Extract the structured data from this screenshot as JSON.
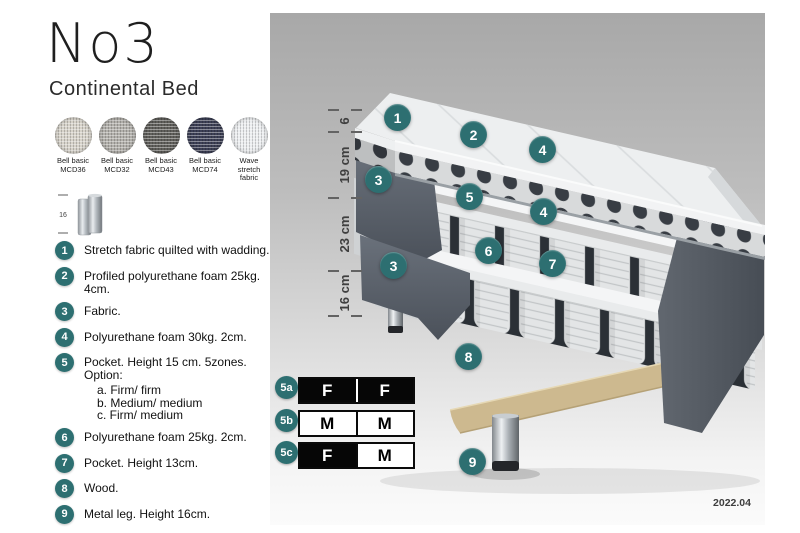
{
  "header": {
    "title": "No3",
    "subtitle": "Continental Bed"
  },
  "swatches": [
    {
      "line1": "Bell basic",
      "line2": "MCD36",
      "color": "#d7d3ca"
    },
    {
      "line1": "Bell basic",
      "line2": "MCD32",
      "color": "#b2b0ab"
    },
    {
      "line1": "Bell basic",
      "line2": "MCD43",
      "color": "#605f5b"
    },
    {
      "line1": "Bell basic",
      "line2": "MCD74",
      "color": "#3d4056"
    },
    {
      "line1": "Wave",
      "line2": "stretch fabric",
      "color": "#eceef0"
    }
  ],
  "leg_thumb": {
    "height_label": "16"
  },
  "materials": [
    {
      "num": "1",
      "text": "Stretch fabric quilted with wadding."
    },
    {
      "num": "2",
      "text": "Profiled polyurethane foam 25kg. 4cm."
    },
    {
      "num": "3",
      "text": "Fabric."
    },
    {
      "num": "4",
      "text": "Polyurethane foam 30kg. 2cm."
    },
    {
      "num": "5",
      "text": "Pocket. Height 15 cm. 5zones. Option:",
      "options": [
        "a. Firm/ firm",
        "b. Medium/ medium",
        "c. Firm/ medium"
      ]
    },
    {
      "num": "6",
      "text": "Polyurethane foam 25kg. 2cm."
    },
    {
      "num": "7",
      "text": "Pocket. Height 13cm."
    },
    {
      "num": "8",
      "text": "Wood."
    },
    {
      "num": "9",
      "text": "Metal leg. Height 16cm."
    }
  ],
  "measurements": [
    {
      "label": "6"
    },
    {
      "label": "19 cm"
    },
    {
      "label": "23 cm"
    },
    {
      "label": "16 cm"
    }
  ],
  "callouts": [
    {
      "num": "1"
    },
    {
      "num": "2"
    },
    {
      "num": "4"
    },
    {
      "num": "3"
    },
    {
      "num": "5"
    },
    {
      "num": "4"
    },
    {
      "num": "6"
    },
    {
      "num": "7"
    },
    {
      "num": "3"
    },
    {
      "num": "8"
    },
    {
      "num": "9"
    }
  ],
  "firmness": {
    "rows": [
      {
        "label": "5a",
        "cells": [
          {
            "value": "F"
          },
          {
            "value": "F"
          }
        ]
      },
      {
        "label": "5b",
        "cells": [
          {
            "value": "M"
          },
          {
            "value": "M"
          }
        ]
      },
      {
        "label": "5c",
        "cells": [
          {
            "value": "F"
          },
          {
            "value": "M"
          }
        ]
      }
    ]
  },
  "footer": {
    "version": "2022.04"
  },
  "colors": {
    "accent_teal": "#2d6f71",
    "upholstery_dark": "#575d67",
    "wood": "#d9c7a0",
    "panel_top": "#a8a8a8",
    "panel_bottom": "#fbfbfb"
  }
}
